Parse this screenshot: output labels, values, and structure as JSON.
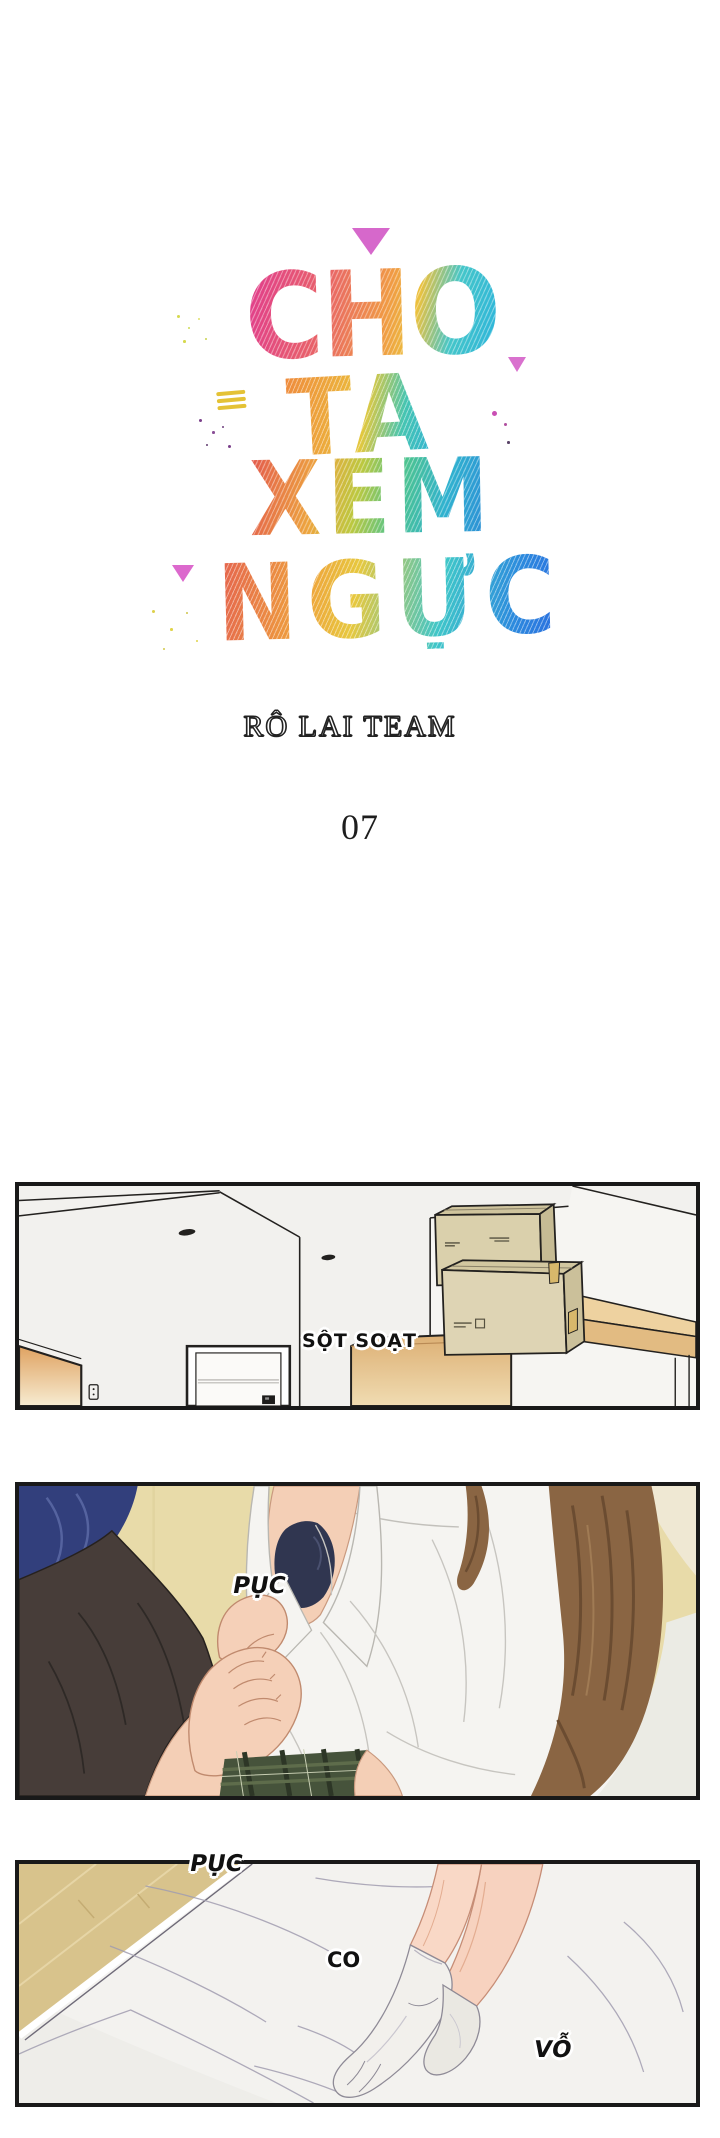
{
  "page": {
    "background": "#ffffff",
    "title": {
      "words": [
        {
          "text": "CHO"
        },
        {
          "text": "TA"
        },
        {
          "text": "XEM"
        },
        {
          "text": "NGỰC"
        }
      ]
    },
    "credit": "RÔ LAI TEAM",
    "chapter_number": "07",
    "title_palette": [
      "#e23a8e",
      "#ef8a3d",
      "#e8c93f",
      "#4ec48e",
      "#35c3d6",
      "#2b6ce0"
    ],
    "decorations": {
      "triangle_color": "#cf4ec2",
      "equals_color": "#e4c235",
      "dot_colors": [
        "#7a3f8a",
        "#c94fb4",
        "#d6d94e",
        "#e0d44a"
      ]
    }
  },
  "panels": [
    {
      "id": "panel-1",
      "description": "empty room interior with stacked moving boxes and wooden shelf",
      "sfx": [
        {
          "text": "SỘT SOẠT"
        }
      ]
    },
    {
      "id": "panel-2",
      "description": "two figures on a bed, a hand gripping an open white shirt",
      "sfx": [
        {
          "text": "PỤC"
        }
      ]
    },
    {
      "id": "panel-3",
      "description": "legs with white socks resting on wrinkled bed sheets",
      "sfx": [
        {
          "text": "PỤC"
        },
        {
          "text": "CO"
        },
        {
          "text": "VỖ"
        }
      ]
    }
  ],
  "panel_style": {
    "border_color": "#191919",
    "sfx_text_color": "#111111"
  }
}
